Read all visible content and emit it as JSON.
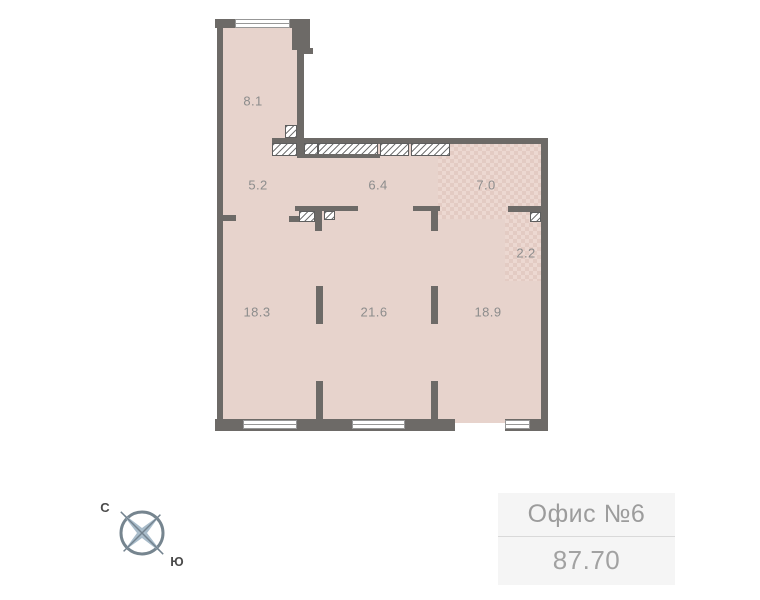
{
  "plan": {
    "rooms": [
      {
        "name": "room-8-1",
        "area": "8.1"
      },
      {
        "name": "room-5-2",
        "area": "5.2"
      },
      {
        "name": "room-6-4",
        "area": "6.4"
      },
      {
        "name": "room-7-0",
        "area": "7.0"
      },
      {
        "name": "room-2-2",
        "area": "2.2"
      },
      {
        "name": "room-18-3",
        "area": "18.3"
      },
      {
        "name": "room-21-6",
        "area": "21.6"
      },
      {
        "name": "room-18-9",
        "area": "18.9"
      }
    ],
    "colors": {
      "floor": "#e7d3cc",
      "floor_checker": "#e3cbc3",
      "wall": "#6d6a67",
      "label_text": "#8c8c8c"
    }
  },
  "compass": {
    "north": "С",
    "south": "Ю"
  },
  "info_box": {
    "title": "Офис №6",
    "area": "87.70"
  }
}
